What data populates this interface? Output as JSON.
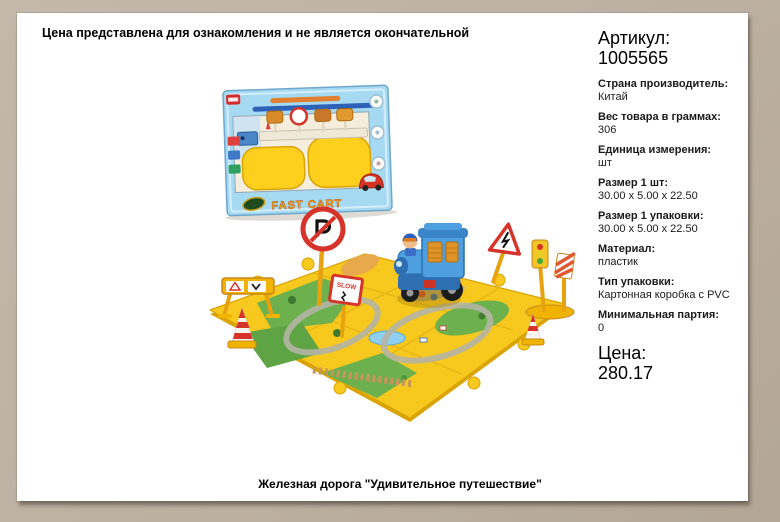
{
  "page": {
    "disclaimer": "Цена представлена для ознакомления и не является окончательной",
    "caption": "Железная дорога \"Удивительное путешествие\""
  },
  "product": {
    "article_label": "Артикул:",
    "article_value": "1005565",
    "details": [
      {
        "label": "Страна производитель:",
        "value": "Китай"
      },
      {
        "label": "Вес товара в граммах:",
        "value": "306"
      },
      {
        "label": "Единица измерения:",
        "value": "шт"
      },
      {
        "label": "Размер 1 шт:",
        "value": "30.00 x 5.00 x 22.50"
      },
      {
        "label": "Размер 1 упаковки:",
        "value": "30.00 x 5.00 x 22.50"
      },
      {
        "label": "Материал:",
        "value": "пластик"
      },
      {
        "label": "Тип упаковки:",
        "value": "Картонная коробка с PVC"
      },
      {
        "label": "Минимальная партия:",
        "value": "0"
      }
    ],
    "price_label": "Цена:",
    "price_value": "280.17"
  },
  "photo": {
    "box_text": "FAST CART",
    "slow_sign_text": "SLOW"
  },
  "colors": {
    "frame": "#bcb0a2",
    "panel": "#ffffff",
    "text": "#1a1a1a",
    "mat_yellow": "#f7c81e",
    "box_blue": "#a6d9f2",
    "train_blue": "#4d9fe0",
    "sign_red": "#d6342a",
    "post_yellow": "#e8a210"
  }
}
